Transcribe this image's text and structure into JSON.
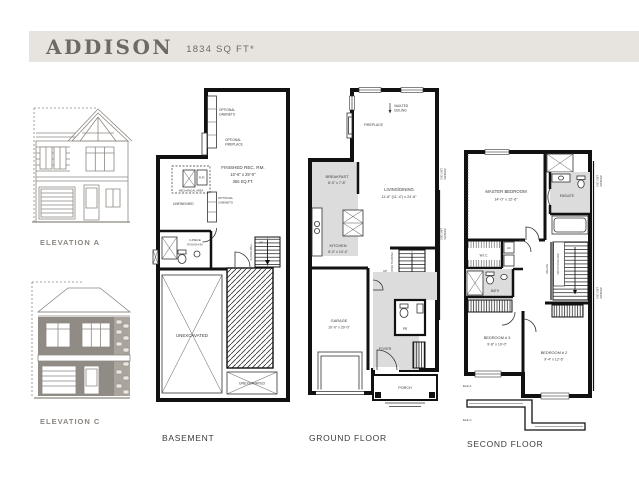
{
  "header": {
    "title": "ADDISON",
    "subtitle": "1834 SQ FT*"
  },
  "elevations": {
    "a_label": "ELEVATION A",
    "c_label": "ELEVATION C"
  },
  "basement": {
    "title": "BASEMENT",
    "opt_cabinets_top": [
      "OPTIONAL",
      "CABINETS"
    ],
    "opt_fireplace": [
      "OPTIONAL",
      "FIREPLACE"
    ],
    "rec_room": {
      "name": "FINISHED REC. RM.",
      "dims": "10'-6\" x 29'-0\"",
      "area": "356 SQ.FT."
    },
    "furnace": "FUR.",
    "mechanical_area": "MECHANICAL AREA",
    "unfinished": "UNFINISHED",
    "opt_cabinets_bottom": [
      "OPTIONAL",
      "CABINETS"
    ],
    "rough_in": [
      "3-PIECE",
      "ROUGH-IN"
    ],
    "up": "UP",
    "sloped_wall": "SLOPED WALL",
    "unexcavated": "UNEXCAVATED",
    "unexcavated_small": "UNEXCAVATED"
  },
  "ground": {
    "title": "GROUND FLOOR",
    "vaulted": [
      "VAULTED",
      "CEILING"
    ],
    "fireplace": "FIREPLACE",
    "living": {
      "name": "LIVING/DINING",
      "dims": "11'-8\" (11'-4\") x 24'-8\""
    },
    "breakfast": {
      "name": "BREAKFAST",
      "dims": "8'-0\" x 7'-8\""
    },
    "kitchen": {
      "name": "KITCHEN",
      "dims": "8'-0\" x 10'-4\""
    },
    "up": "UP",
    "open_above": "OPEN TO ABOVE",
    "garage": {
      "name": "GARAGE",
      "dims": "10'-0\" x 20'-0\""
    },
    "foyer": "FOYER",
    "powder_room": "PR",
    "porch": "PORCH",
    "end_unit_window": [
      "END UNIT",
      "WINDOW"
    ]
  },
  "second": {
    "title": "SECOND FLOOR",
    "master": {
      "name": "MASTER BEDROOM",
      "dims": "14'-0\" x 12'-6\""
    },
    "ensuite": "ENSUITE",
    "wic": "W.I.C.",
    "linen": "LIN.",
    "bath": "BATH",
    "railing": "RAILING",
    "open_below": "OPEN TO BELOW",
    "bedroom3": {
      "name": "BEDROOM # 3",
      "dims": "9'-8\" x 10'-0\""
    },
    "bedroom2": {
      "name": "BEDROOM # 2",
      "dims": "9'-4\" x 12'-6\""
    },
    "ele_a": "ELE A",
    "ele_c": "ELE C",
    "end_unit_window": [
      "END UNIT",
      "WINDOW"
    ]
  },
  "colors": {
    "header_band": "#e7e4e0",
    "header_text": "#6f6963",
    "elevation_line": "#8d8781",
    "wall": "#111111",
    "room_shade": "#dcdcdc"
  }
}
